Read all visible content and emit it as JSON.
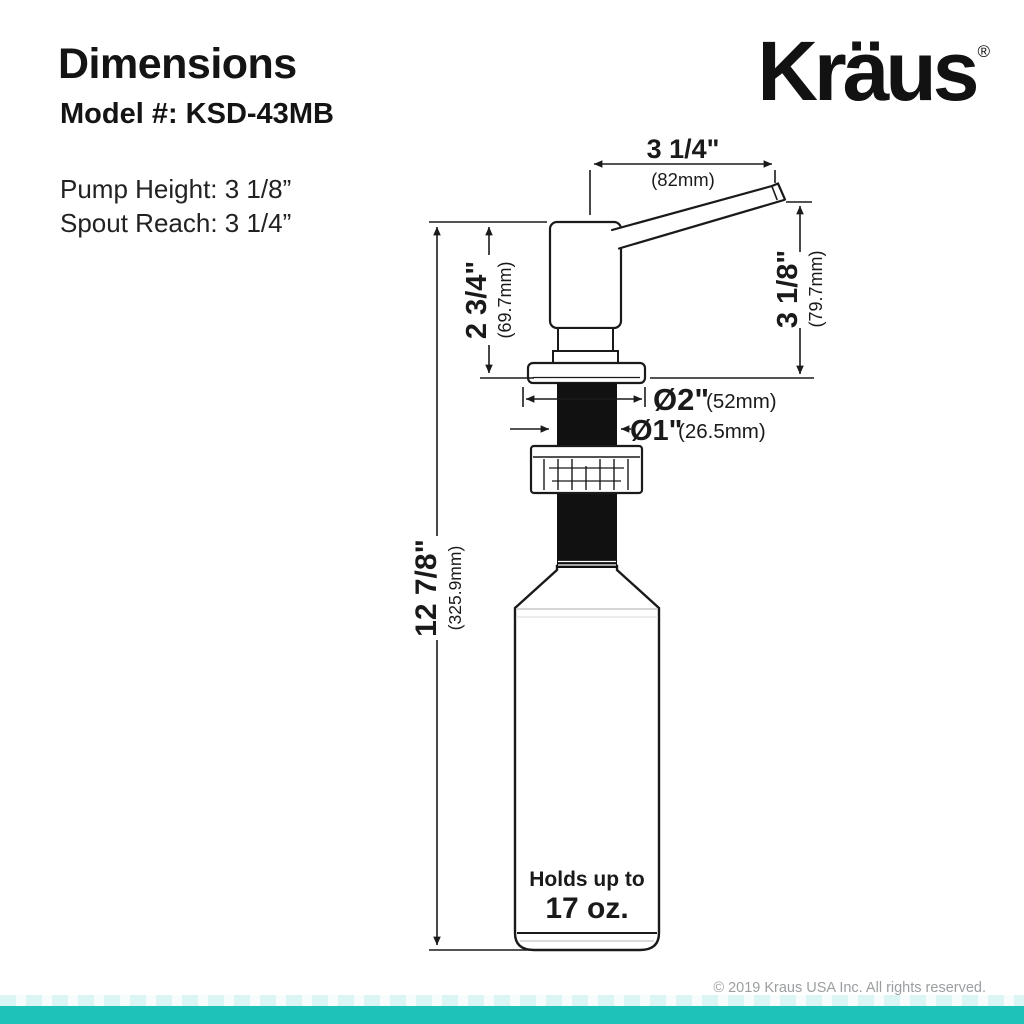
{
  "header": {
    "title": "Dimensions",
    "model_label": "Model #: KSD-43MB",
    "pump_height": "Pump Height: 3 1/8”",
    "spout_reach": "Spout Reach: 3 1/4”"
  },
  "logo": {
    "text": "Kräus",
    "registered": "®"
  },
  "diagram": {
    "spout_reach": {
      "inches": "3 1/4\"",
      "mm": "(82mm)"
    },
    "pump_height": {
      "inches": "2 3/4\"",
      "mm": "(69.7mm)"
    },
    "spout_height": {
      "inches": "3 1/8\"",
      "mm": "(79.7mm)"
    },
    "flange_diameter": {
      "inches": "Ø2\"",
      "mm": "(52mm)"
    },
    "shaft_diameter": {
      "inches": "Ø1\"",
      "mm": "(26.5mm)"
    },
    "total_height": {
      "inches": "12 7/8\"",
      "mm": "(325.9mm)"
    },
    "bottle": {
      "capacity_line1": "Holds up to",
      "capacity_line2": "17 oz."
    }
  },
  "footer": {
    "copyright": "© 2019 Kraus USA Inc. All rights reserved.",
    "accent_color": "#1FC2B8"
  }
}
